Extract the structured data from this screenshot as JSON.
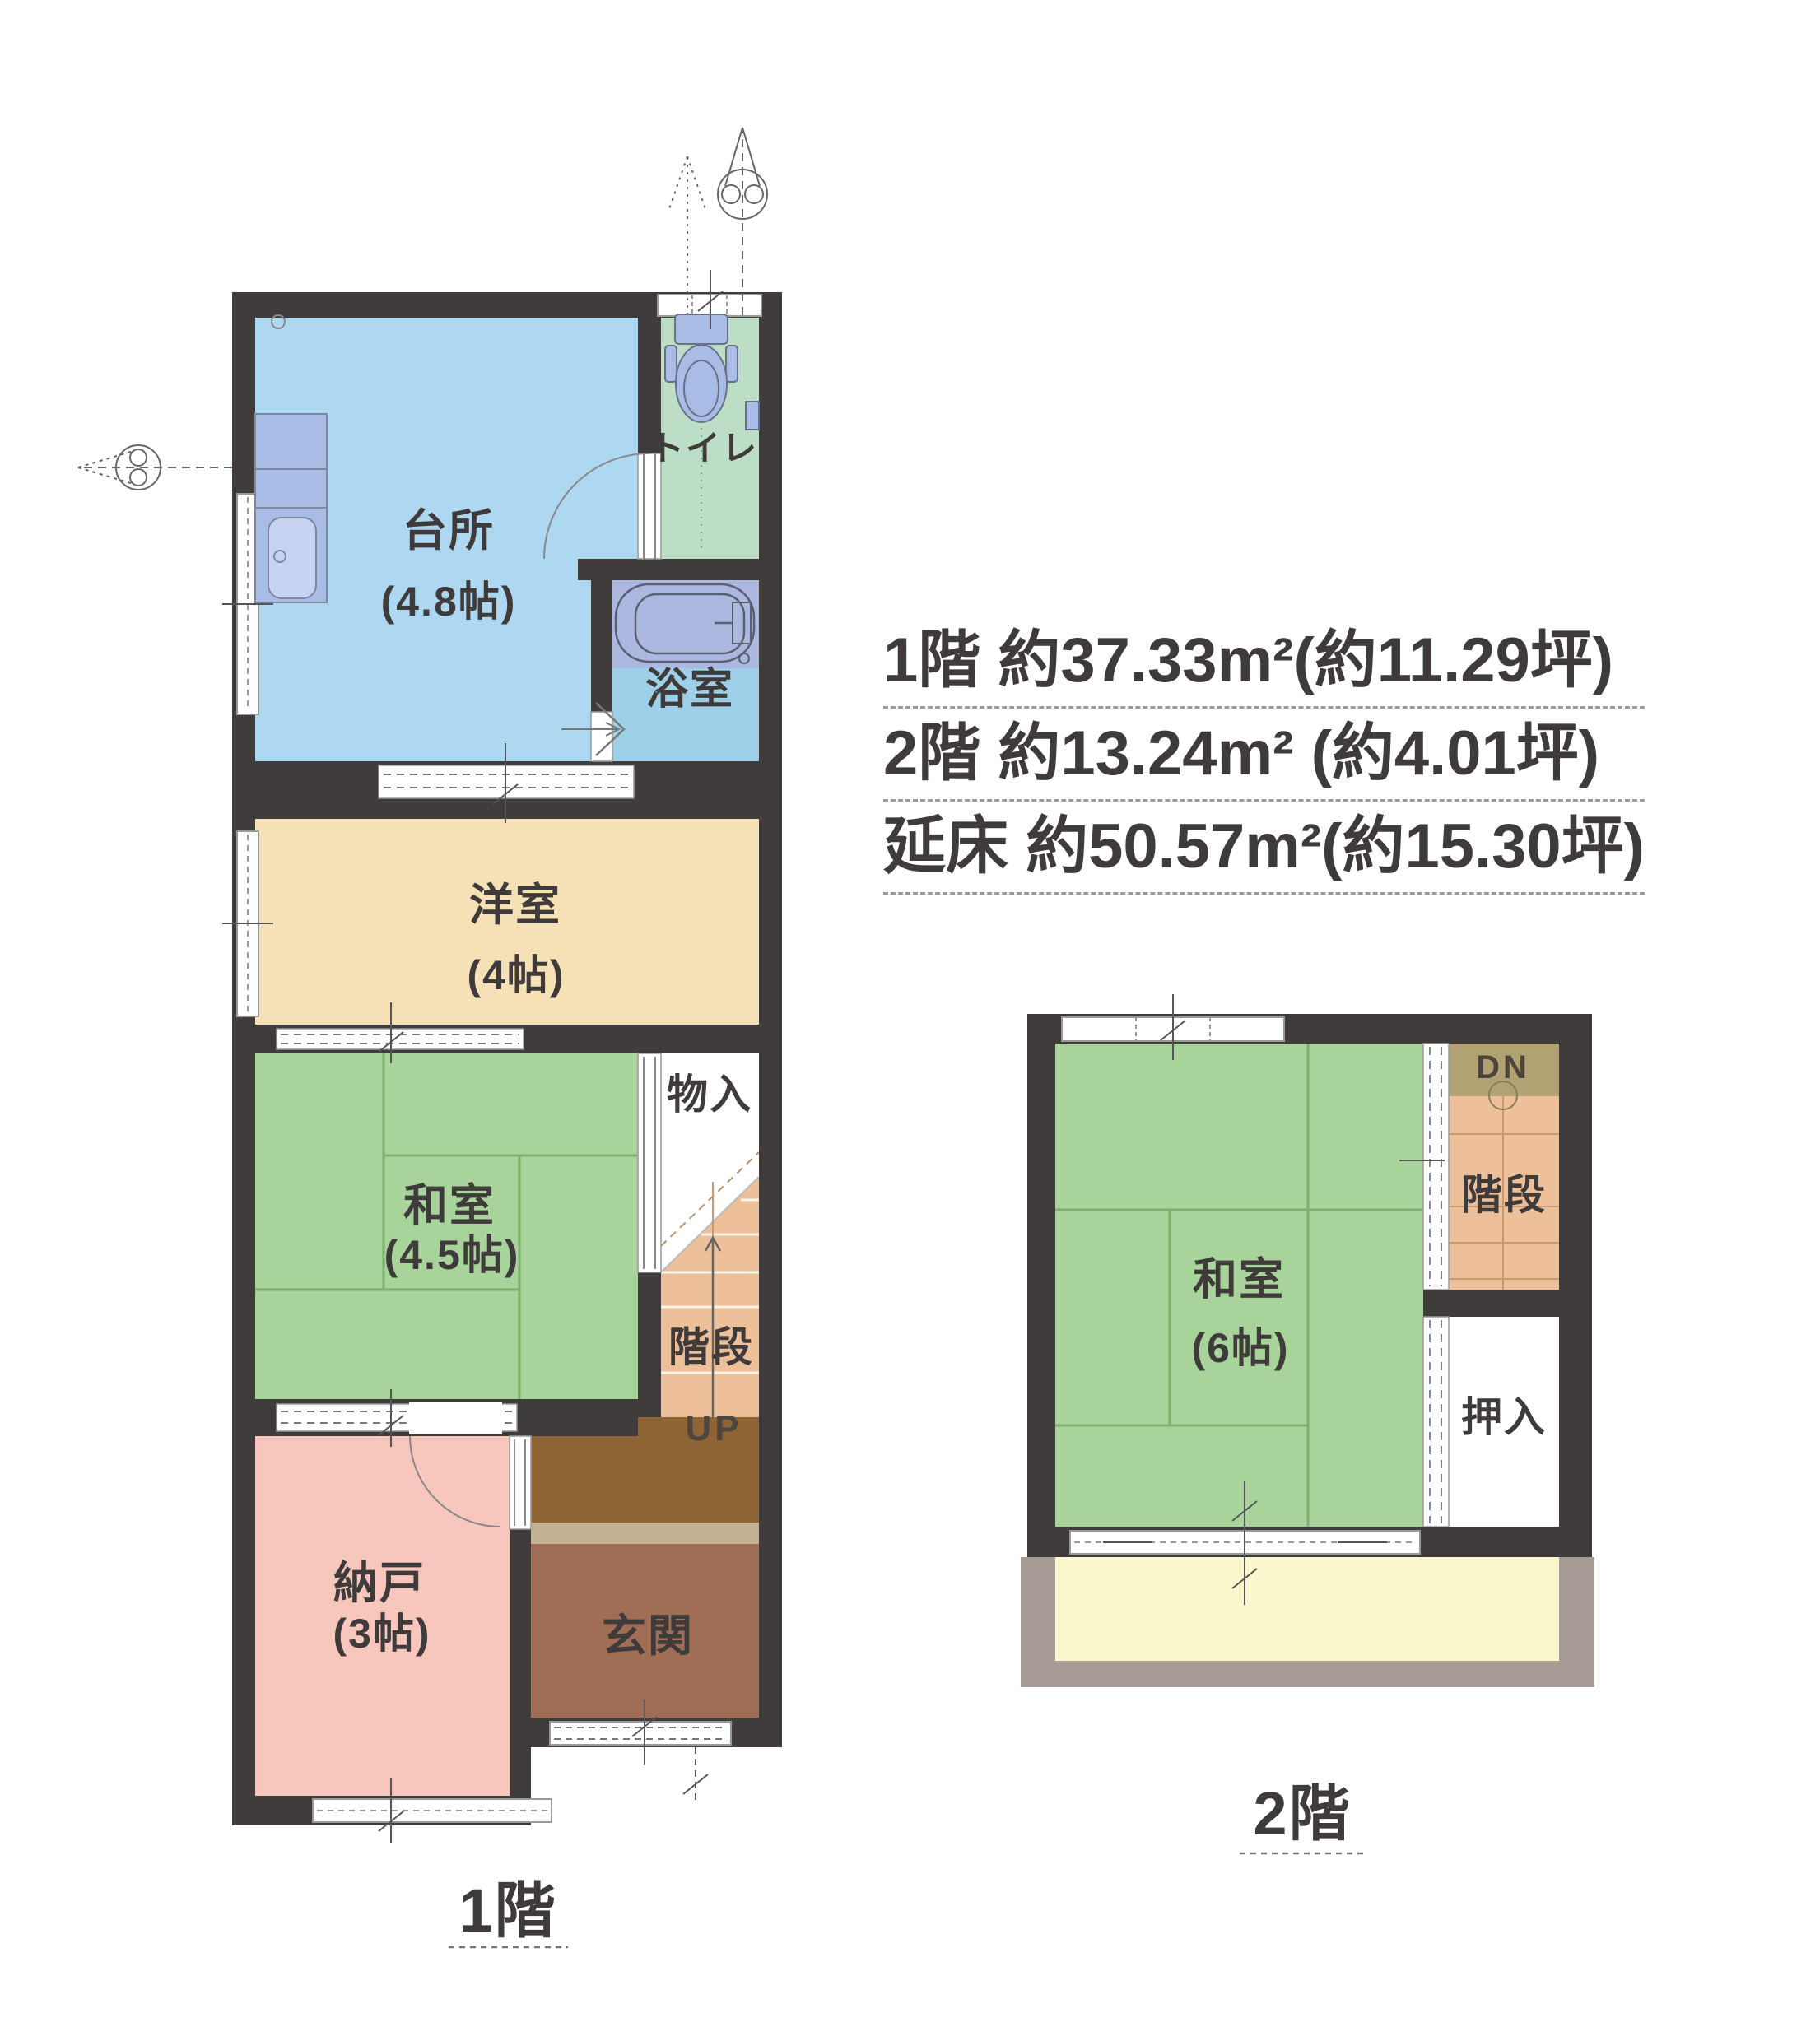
{
  "document": {
    "type": "floor-plan",
    "language": "ja"
  },
  "floor1": {
    "label": "1階",
    "rooms": {
      "kitchen": {
        "name": "台所",
        "size": "(4.8帖)"
      },
      "toilet": {
        "name": "トイレ"
      },
      "bath": {
        "name": "浴室"
      },
      "western": {
        "name": "洋室",
        "size": "(4帖)"
      },
      "japanese": {
        "name": "和室",
        "size": "(4.5帖)"
      },
      "storage": {
        "name": "物入"
      },
      "stairs": {
        "name": "階段",
        "direction": "UP"
      },
      "back_room": {
        "name": "納戸",
        "size": "(3帖)"
      },
      "entrance": {
        "name": "玄関"
      }
    }
  },
  "floor2": {
    "label": "2階",
    "rooms": {
      "japanese": {
        "name": "和室",
        "size": "(6帖)"
      },
      "stairs": {
        "name": "階段",
        "direction": "DN"
      },
      "closet": {
        "name": "押入"
      }
    }
  },
  "area_summary": {
    "rows": [
      {
        "text": "1階 約37.33m²(約11.29坪)"
      },
      {
        "text": "2階 約13.24m²  (約4.01坪)"
      },
      {
        "text": "延床 約50.57m²(約15.30坪)"
      }
    ]
  },
  "colors": {
    "wall": "#403c3b",
    "kitchen_floor": "#aed8f2",
    "toilet_floor": "#bcdec6",
    "bath_floor": "#9fd0ea",
    "bath_tub_zone": "#adb8e0",
    "western_room_floor": "#f6e0b5",
    "tatami_floor": "#a8d39b",
    "tatami_line": "#7cb26b",
    "back_room_floor": "#f7c7be",
    "stairs_floor": "#eec099",
    "stairs_top_floor": "#b2a172",
    "entrance_hall_floor": "#8f6434",
    "entrance_step": "#c4b194",
    "entrance_tataki": "#a06d55",
    "balcony_floor": "#fbf7cc",
    "balcony_edge": "#a69b94",
    "fixture_fill": "#a9bce6",
    "label_text": "#3e3b3a"
  }
}
